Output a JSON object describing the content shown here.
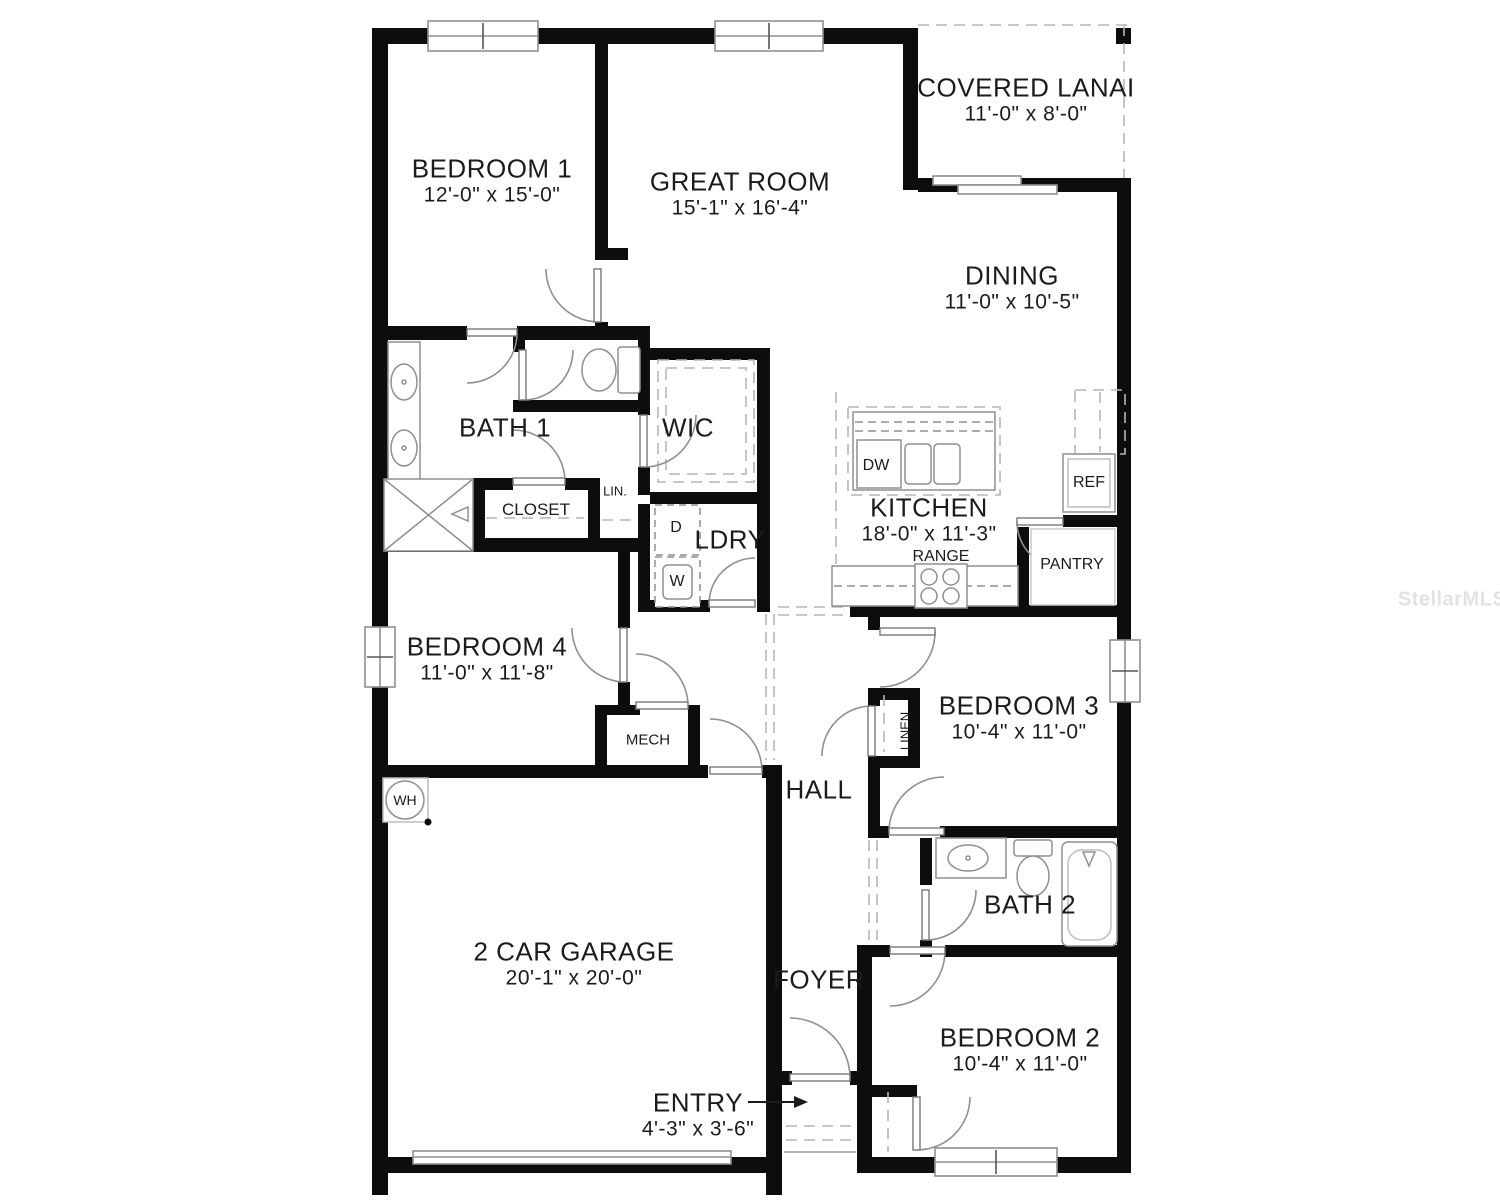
{
  "plan": {
    "title": "Single story 4-bedroom floor plan",
    "watermark": "StellarMLS",
    "rooms": [
      {
        "name": "BEDROOM 1",
        "dims": "12'-0\" x 15'-0\""
      },
      {
        "name": "GREAT ROOM",
        "dims": "15'-1\" x 16'-4\""
      },
      {
        "name": "COVERED LANAI",
        "dims": "11'-0\" x 8'-0\""
      },
      {
        "name": "DINING",
        "dims": "11'-0\" x 10'-5\""
      },
      {
        "name": "BATH 1",
        "dims": ""
      },
      {
        "name": "WIC",
        "dims": ""
      },
      {
        "name": "LDRY",
        "dims": ""
      },
      {
        "name": "KITCHEN",
        "dims": "18'-0\" x 11'-3\""
      },
      {
        "name": "BEDROOM 4",
        "dims": "11'-0\" x 11'-8\""
      },
      {
        "name": "BEDROOM 3",
        "dims": "10'-4\" x 11'-0\""
      },
      {
        "name": "HALL",
        "dims": ""
      },
      {
        "name": "2 CAR GARAGE",
        "dims": "20'-1\" x 20'-0\""
      },
      {
        "name": "BATH 2",
        "dims": ""
      },
      {
        "name": "FOYER",
        "dims": ""
      },
      {
        "name": "BEDROOM 2",
        "dims": "10'-4\" x 11'-0\""
      },
      {
        "name": "ENTRY",
        "dims": "4'-3\" x 3'-6\""
      }
    ],
    "labels": [
      {
        "text": "CLOSET"
      },
      {
        "text": "LIN."
      },
      {
        "text": "D"
      },
      {
        "text": "W"
      },
      {
        "text": "DW"
      },
      {
        "text": "REF"
      },
      {
        "text": "RANGE"
      },
      {
        "text": "PANTRY"
      },
      {
        "text": "MECH"
      },
      {
        "text": "WH"
      },
      {
        "text": "LINEN"
      }
    ],
    "colors": {
      "wall": "#0d0d0d",
      "fixture": "#8f8f8f",
      "dash": "#b5b5b5",
      "text": "#1b1b1b",
      "watermark": "#e2e2e2",
      "background": "#ffffff"
    }
  }
}
